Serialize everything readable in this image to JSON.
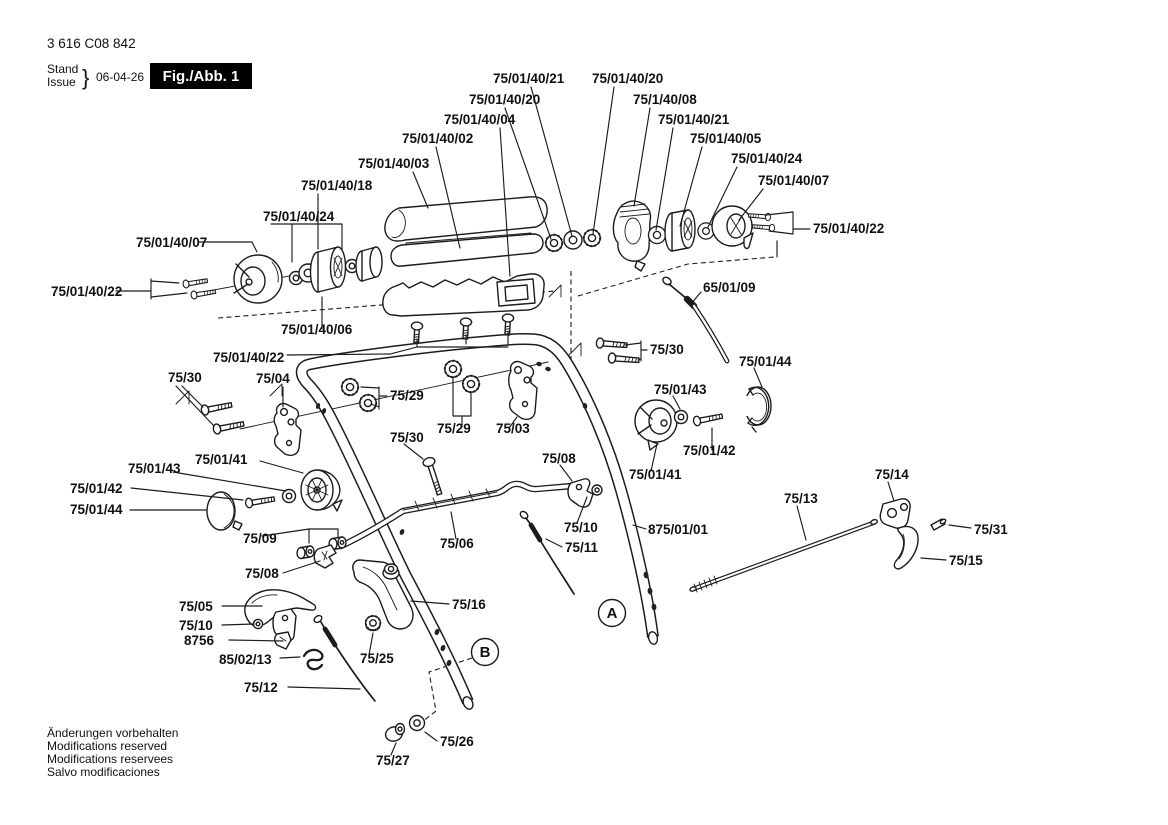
{
  "header": {
    "part_number": "3 616 C08 842",
    "stand_word": "Stand",
    "issue_word": "Issue",
    "brace": "}",
    "date": "06-04-26",
    "figure_label": "Fig./Abb. 1"
  },
  "footer_lines": [
    "Änderungen vorbehalten",
    "Modifications reserved",
    "Modifications reservees",
    "Salvo modificaciones"
  ],
  "callouts": {
    "a": "A",
    "b": "B"
  },
  "labels": [
    {
      "text": "75/01/40/21"
    },
    {
      "text": "75/01/40/20"
    },
    {
      "text": "75/01/40/20"
    },
    {
      "text": "75/1/40/08"
    },
    {
      "text": "75/01/40/04"
    },
    {
      "text": "75/01/40/21"
    },
    {
      "text": "75/01/40/02"
    },
    {
      "text": "75/01/40/05"
    },
    {
      "text": "75/01/40/03"
    },
    {
      "text": "75/01/40/24"
    },
    {
      "text": "75/01/40/07"
    },
    {
      "text": "75/01/40/18"
    },
    {
      "text": "75/01/40/24"
    },
    {
      "text": "75/01/40/07"
    },
    {
      "text": "75/01/40/22"
    },
    {
      "text": "75/01/40/22"
    },
    {
      "text": "75/01/40/06"
    },
    {
      "text": "65/01/09"
    },
    {
      "text": "75/01/40/22"
    },
    {
      "text": "75/30"
    },
    {
      "text": "75/04"
    },
    {
      "text": "75/29"
    },
    {
      "text": "75/30"
    },
    {
      "text": "75/01/44"
    },
    {
      "text": "75/01/43"
    },
    {
      "text": "75/29"
    },
    {
      "text": "75/03"
    },
    {
      "text": "75/30"
    },
    {
      "text": "75/01/41"
    },
    {
      "text": "75/01/43"
    },
    {
      "text": "75/01/42"
    },
    {
      "text": "75/01/42"
    },
    {
      "text": "75/01/41"
    },
    {
      "text": "75/01/44"
    },
    {
      "text": "875/01/01"
    },
    {
      "text": "75/08"
    },
    {
      "text": "75/10"
    },
    {
      "text": "75/11"
    },
    {
      "text": "75/06"
    },
    {
      "text": "75/09"
    },
    {
      "text": "75/08"
    },
    {
      "text": "75/13"
    },
    {
      "text": "75/14"
    },
    {
      "text": "75/31"
    },
    {
      "text": "75/15"
    },
    {
      "text": "75/05"
    },
    {
      "text": "75/10"
    },
    {
      "text": "8756"
    },
    {
      "text": "75/16"
    },
    {
      "text": "85/02/13"
    },
    {
      "text": "75/25"
    },
    {
      "text": "75/12"
    },
    {
      "text": "75/26"
    },
    {
      "text": "75/27"
    }
  ]
}
